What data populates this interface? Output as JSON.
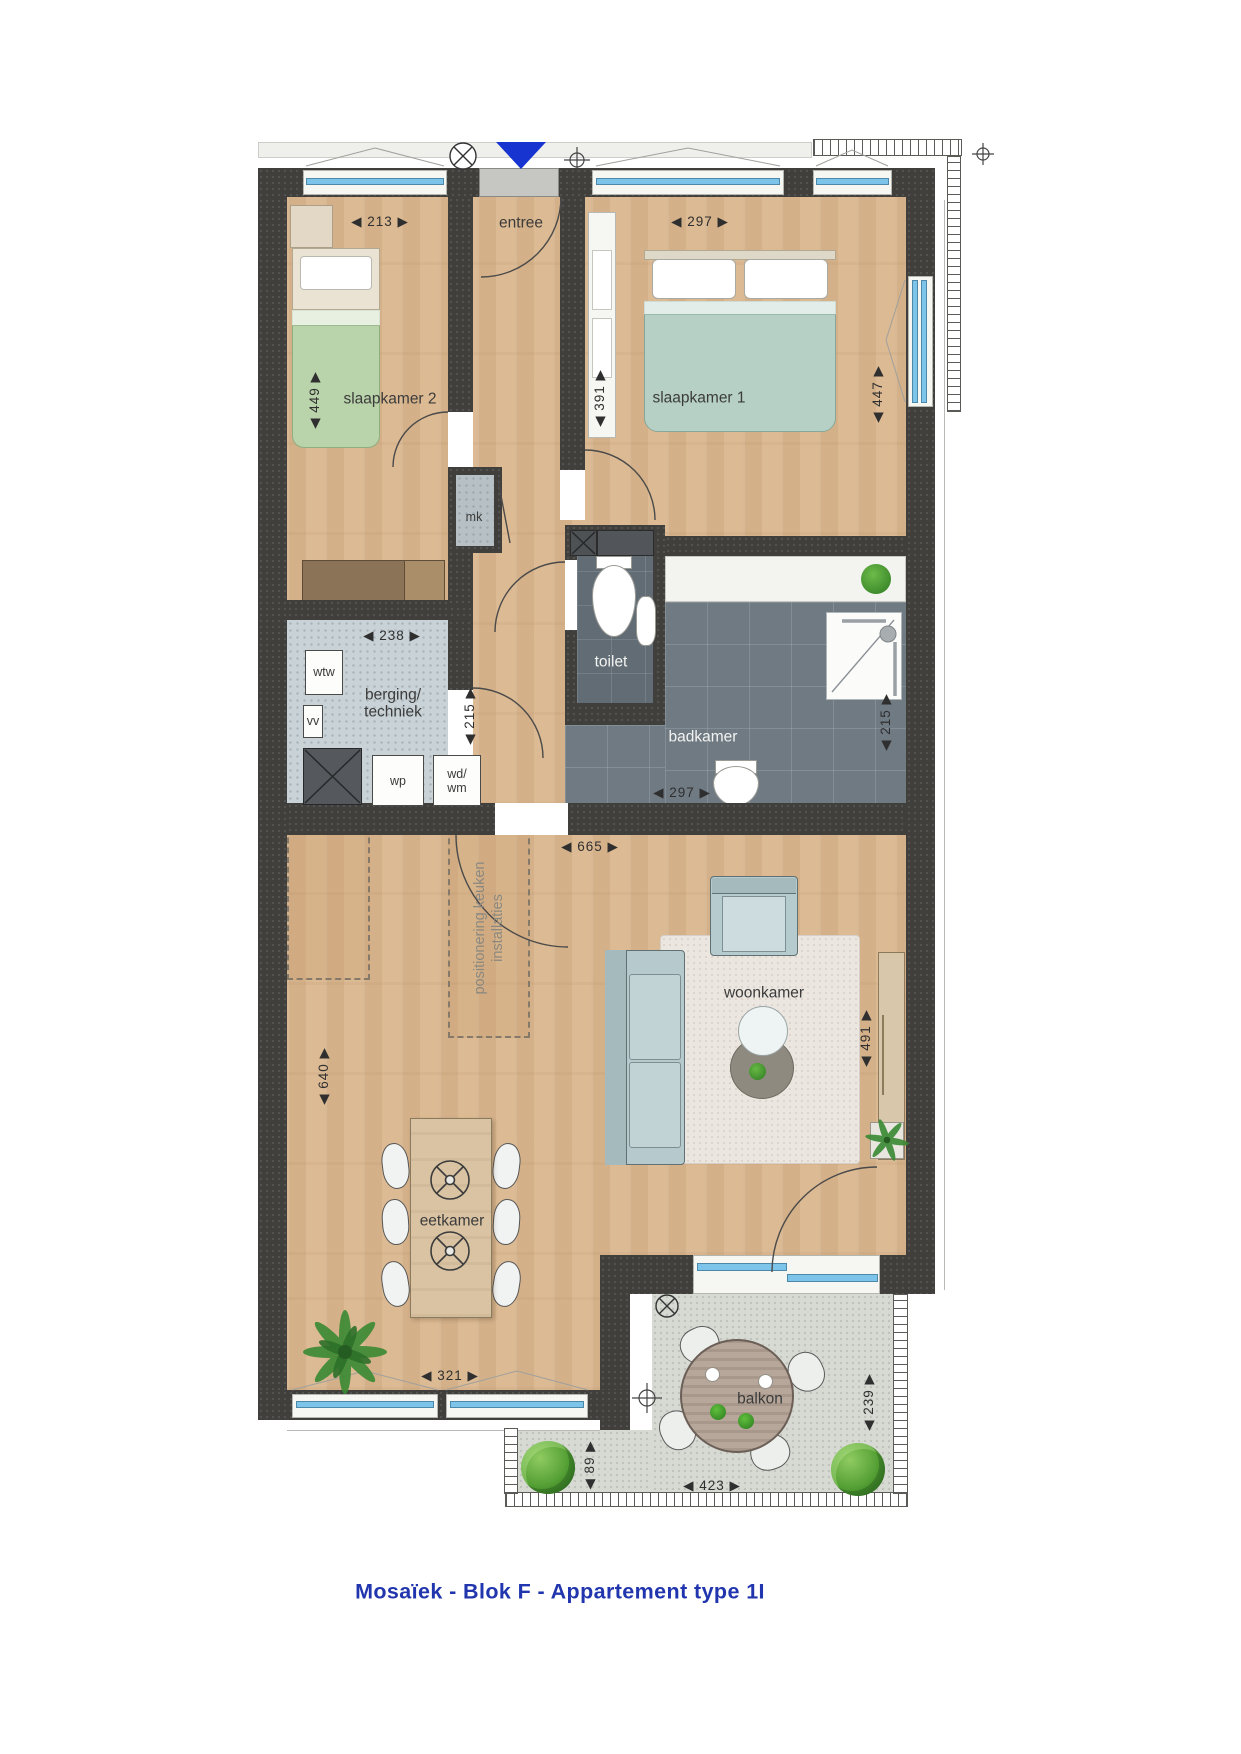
{
  "title": "Mosaïek - Blok F - Appartement type 1I",
  "labels": {
    "entree": "entree",
    "slaapkamer2": "slaapkamer 2",
    "slaapkamer1": "slaapkamer 1",
    "mk": "mk",
    "wtw": "wtw",
    "vv": "vv",
    "berging_line1": "berging/",
    "berging_line2": "techniek",
    "wp": "wp",
    "wdwm_line1": "wd/",
    "wdwm_line2": "wm",
    "toilet": "toilet",
    "badkamer": "badkamer",
    "woonkamer": "woonkamer",
    "eetkamer": "eetkamer",
    "balkon": "balkon",
    "keuken_note_line1": "positionering keuken",
    "keuken_note_line2": "installaties"
  },
  "dimensions": {
    "slaapkamer2_breedte": "◀ 213 ▶",
    "slaapkamer2_diepte": "◀ 449 ▶",
    "slaapkamer1_breedte": "◀ 297 ▶",
    "slaapkamer1_nis": "◀ 391 ▶",
    "slaapkamer1_diepte": "◀ 447 ▶",
    "berging_breedte": "◀ 238 ▶",
    "berging_diepte": "◀ 215 ▶",
    "badkamer_breedte": "◀ 297 ▶",
    "badkamer_diepte": "◀ 215 ▶",
    "woonkamer_opening": "◀ 665 ▶",
    "woonkamer_links": "◀ 640 ▶",
    "woonkamer_rechts": "◀ 491 ▶",
    "eetkamer_breedte": "◀ 321 ▶",
    "balkon_breedte": "◀ 423 ▶",
    "balkon_diepte": "◀ 239 ▶",
    "balkon_zijde": "◀ 89 ▶"
  },
  "colors": {
    "wall": "#403f3c",
    "floor_wood": "#dcba93",
    "floor_tile": "#6f7a83",
    "floor_storage": "#c9d2d6",
    "glass_blue": "#7cc4ea",
    "entrance_marker_blue": "#1734d1",
    "bed_green": "#b9d3aa",
    "bed_teal": "#b6d0c5",
    "title_blue": "#2136ae"
  }
}
